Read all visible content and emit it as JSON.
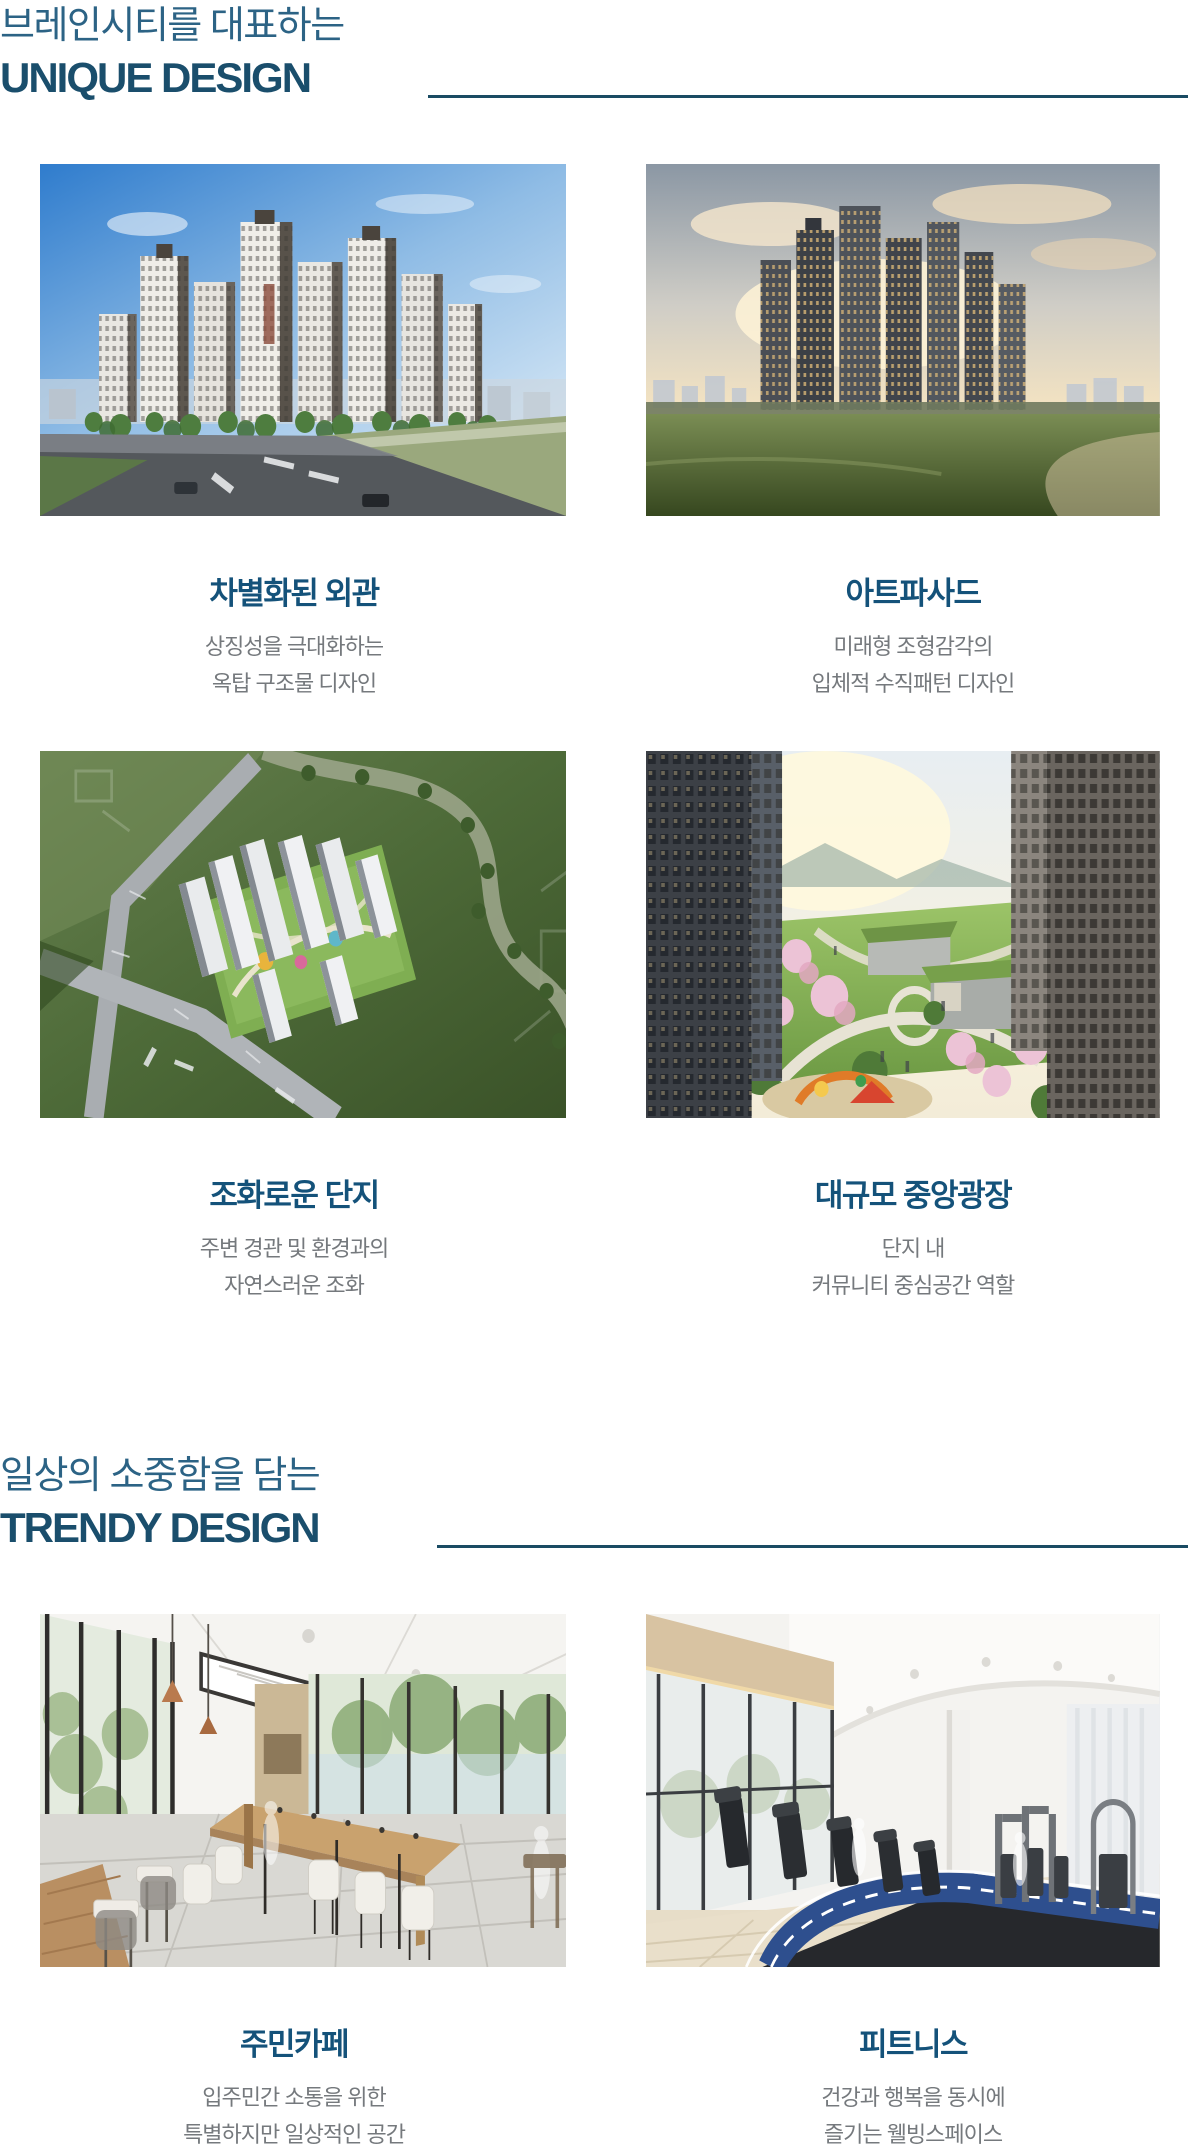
{
  "page": {
    "background": "#ffffff",
    "language": "ko"
  },
  "colors": {
    "kicker_text": "#2c6385",
    "section_title": "#1a4e6c",
    "divider_rule": "#1a4b63",
    "card_title": "#14527a",
    "card_description": "#75797d"
  },
  "sections": [
    {
      "kicker": "브레인시티를 대표하는",
      "title": "UNIQUE DESIGN",
      "cards": [
        {
          "image": "daytime-apartment-towers-render",
          "title": "차별화된 외관",
          "desc": [
            "상징성을 극대화하는",
            "옥탑 구조물 디자인"
          ]
        },
        {
          "image": "sunset-apartment-towers-render",
          "title": "아트파사드",
          "desc": [
            "미래형 조형감각의",
            "입체적 수직패턴 디자인"
          ]
        },
        {
          "image": "aerial-complex-render",
          "title": "조화로운 단지",
          "desc": [
            "주변 경관 및 환경과의",
            "자연스러운 조화"
          ]
        },
        {
          "image": "central-plaza-cherry-blossom-render",
          "title": "대규모 중앙광장",
          "desc": [
            "단지 내",
            "커뮤니티 중심공간 역할"
          ]
        }
      ]
    },
    {
      "kicker": "일상의 소중함을 담는",
      "title": "TRENDY DESIGN",
      "cards": [
        {
          "image": "residents-cafe-interior-render",
          "title": "주민카페",
          "desc": [
            "입주민간 소통을 위한",
            "특별하지만 일상적인 공간"
          ]
        },
        {
          "image": "fitness-center-interior-render",
          "title": "피트니스",
          "desc": [
            "건강과 행복을 동시에",
            "즐기는 웰빙스페이스"
          ]
        }
      ]
    }
  ]
}
